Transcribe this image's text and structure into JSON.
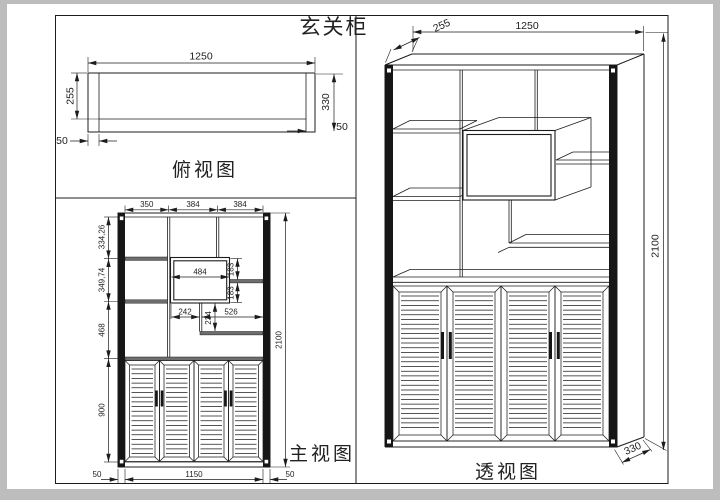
{
  "drawing": {
    "title": "玄关柜",
    "views": {
      "top": {
        "label": "俯视图",
        "dims": {
          "width": "1250",
          "body_depth": "255",
          "total_depth": "330",
          "post_left": "50",
          "post_right": "50"
        }
      },
      "front": {
        "label": "主视图",
        "dims": {
          "bay1": "350",
          "bay2": "384",
          "bay3": "384",
          "row1": "334,26",
          "row2": "349,74",
          "row3": "468",
          "doors_h": "900",
          "total_h": "2100",
          "niche_w": "484",
          "niche_upper": "183",
          "niche_lower": "183",
          "step_left": "242",
          "step_drop": "234",
          "step_right": "526",
          "base_left": "50",
          "base_mid": "1150",
          "base_right": "50"
        }
      },
      "perspective": {
        "label": "透视图",
        "dims": {
          "width": "1250",
          "top_depth": "255",
          "height": "2100",
          "base_depth": "330"
        }
      }
    }
  }
}
